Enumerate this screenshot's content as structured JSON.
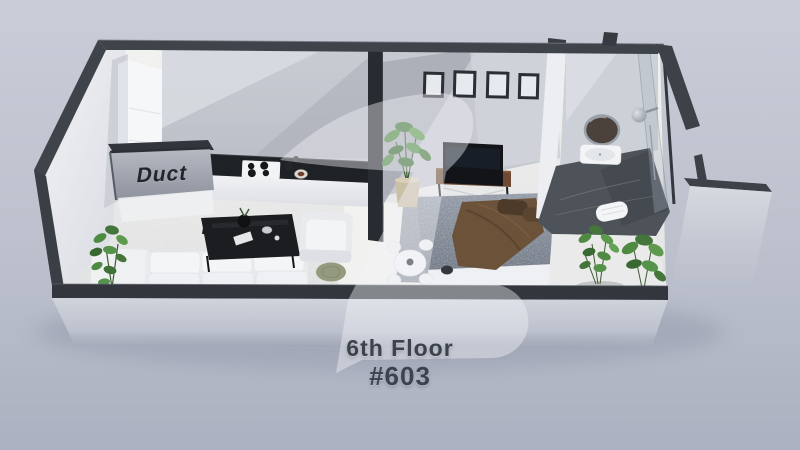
{
  "labels": {
    "duct": "Duct",
    "floor": "6th Floor",
    "unit": "#603"
  },
  "watermark": {
    "icon": "z-logo-watermark",
    "color": "#f2f4f7",
    "opacity": 0.42
  },
  "colors": {
    "background_top": "#c9cdd8",
    "background_bottom": "#abb1c0",
    "wall_cut_dark": "#3f444b",
    "wall_face_light": "#eef0f3",
    "interior_wall": "#c7cad1",
    "kitchen_counter": "#1e2125",
    "floor_marble": "#ebebe9",
    "bedroom_rug": "#8f96a2",
    "bed_blanket_brown": "#6b5238",
    "pillow_brown": "#4e3a28",
    "wood_console": "#6e4a33",
    "plant_green": "#4f8a43",
    "bathroom_floor": "#4e535a",
    "caption_text": "#3d434d",
    "duct_text": "#22262c"
  }
}
